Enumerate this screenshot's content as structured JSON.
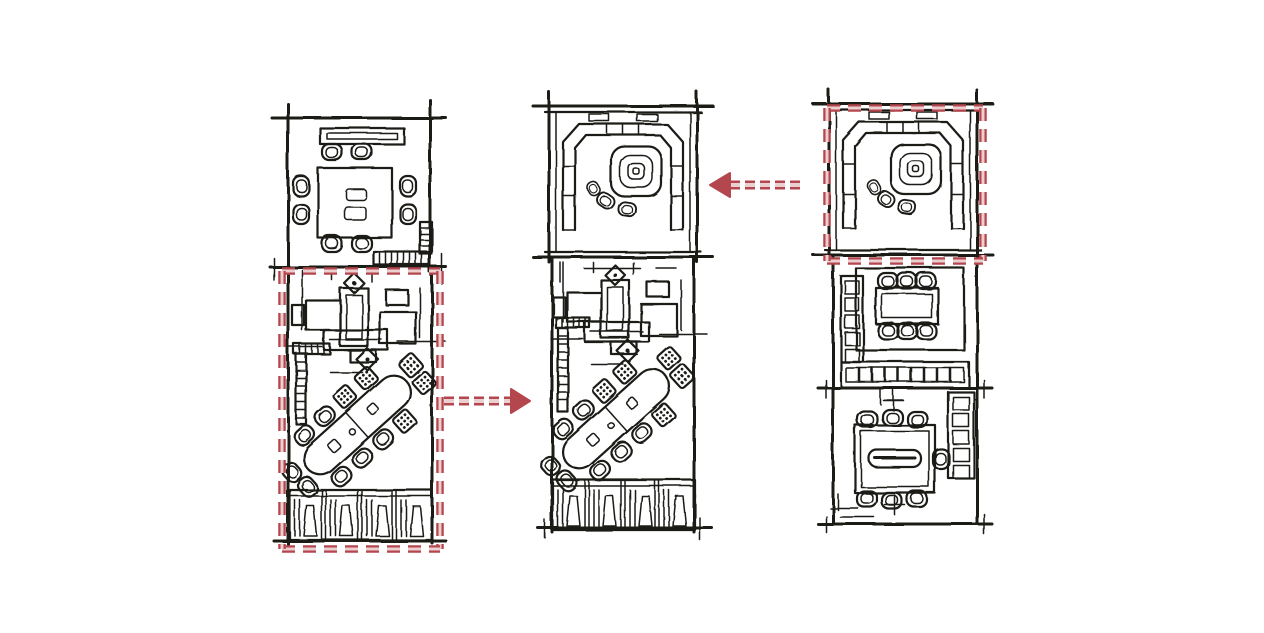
{
  "colors": {
    "paper": "#ffffff",
    "ink": "#1c1a19",
    "accent": "#b4464d",
    "accent_core": "#eccfd0"
  },
  "diagram": {
    "kind": "hand-drawn floor plan option study",
    "plans": [
      {
        "id": "plan-left",
        "sections": [
          "dining-room-8-seat-table",
          "office-desk-cluster",
          "diagonal-conference-table",
          "storage-shelf-row"
        ],
        "highlighted_section": "lower-two-thirds"
      },
      {
        "id": "plan-middle",
        "sections": [
          "u-shaped-lounge-with-square-table",
          "office-desk-cluster",
          "diagonal-conference-table",
          "storage-shelf-row"
        ],
        "highlighted_section": null
      },
      {
        "id": "plan-right",
        "sections": [
          "u-shaped-lounge-with-square-table",
          "meeting-table-room-6-chairs",
          "conference-room-with-shelving"
        ],
        "highlighted_section": "top"
      }
    ],
    "arrows": [
      {
        "name": "arrow-left-icon",
        "direction": "left",
        "from": "plan-right-top-section",
        "to": "plan-middle-top-section"
      },
      {
        "name": "arrow-right-icon",
        "direction": "right",
        "from": "plan-left-lower-section",
        "to": "plan-middle-lower-section"
      }
    ],
    "highlights": [
      {
        "name": "highlight-outline-left-lower",
        "style": "red-dashed-rectangle"
      },
      {
        "name": "highlight-outline-right-top",
        "style": "red-dashed-rectangle"
      }
    ]
  }
}
